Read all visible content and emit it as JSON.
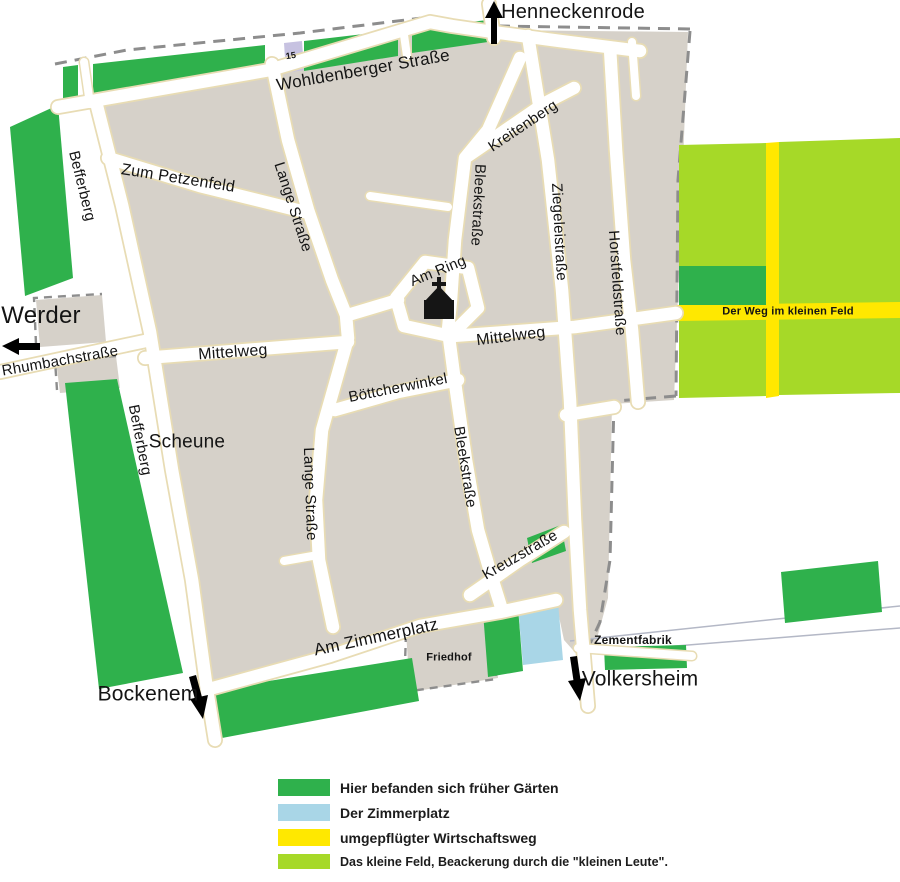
{
  "colors": {
    "garden_green": "#2fb14c",
    "zimmerplatz_blue": "#a9d6e7",
    "wirtschaftsweg_yellow": "#ffe800",
    "kleines_feld_lime": "#a6d928",
    "village_gray": "#d6d1c9",
    "plot15_lavender": "#c7c2e1"
  },
  "map": {
    "plot_number": "15",
    "destinations": {
      "henneckenrode": "Henneckenrode",
      "werder": "Werder",
      "bockenem": "Bockenem",
      "volkersheim": "Volkersheim"
    },
    "places": {
      "scheune": "Scheune",
      "friedhof": "Friedhof",
      "zementfabrik": "Zementfabrik"
    },
    "streets": {
      "wohldenberger_strasse": "Wohldenberger Straße",
      "zum_petzenfeld": "Zum Petzenfeld",
      "befferberg_north": "Befferberg",
      "befferberg_south": "Befferberg",
      "lange_strasse_north": "Lange Straße",
      "lange_strasse_south": "Lange Straße",
      "kreitenberg": "Kreitenberg",
      "bleekstrasse_north": "Bleekstraße",
      "bleekstrasse_south": "Bleekstraße",
      "ziegeleistrasse": "Ziegeleistraße",
      "horstfeldstrasse": "Horstfeldstraße",
      "am_ring": "Am Ring",
      "rhumbachstrasse": "Rhumbachstraße",
      "mittelweg_west": "Mittelweg",
      "mittelweg_east": "Mittelweg",
      "boettcherwinkel": "Böttcherwinkel",
      "kreuzstrasse": "Kreuzstraße",
      "am_zimmerplatz": "Am Zimmerplatz",
      "weg_im_kleinen_feld": "Der Weg im kleinen Feld"
    }
  },
  "legend": {
    "items": [
      {
        "label": "Hier befanden sich früher Gärten"
      },
      {
        "label": "Der Zimmerplatz"
      },
      {
        "label": "umgepflügter Wirtschaftsweg"
      },
      {
        "label": "Das kleine Feld,  Beackerung durch die \"kleinen Leute\"."
      }
    ]
  }
}
